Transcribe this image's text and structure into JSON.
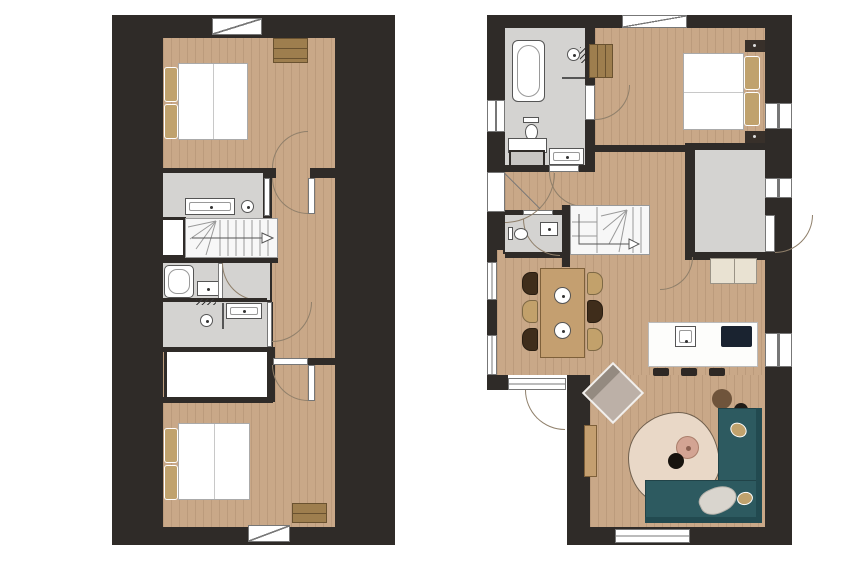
{
  "palette": {
    "page_bg": "#ffffff",
    "wall": "#2f2b28",
    "wood": "#c9a888",
    "wood_grain": "rgba(96,66,40,0.13)",
    "tile": "#d4d3d1",
    "stair": "#f7f7f7",
    "line": "#8f7f6a",
    "window_line": "#777777",
    "fixture_line": "#555555",
    "sofa": "#2d5a60",
    "sofa_dark": "#224a50",
    "rug": "#e9d8c7",
    "rug_line": "#70604e",
    "coffee": "#d3a493",
    "coffee_line": "#aa7e6b",
    "armchair": "#bcb0a7",
    "armchair_back": "#948a80",
    "pouf_brown": "#6f543b",
    "pouf_black": "#201c17",
    "chair_dark": "#3f2d1b",
    "chair_tan": "#c2a16b",
    "furn_wood": "#c49f70",
    "furn_wood_line": "#7e603a",
    "dresser": "#9e7e4e",
    "dresser_line": "#6a5230",
    "pillow": "#c0a26d",
    "cooktop": "#1a2330",
    "cabinet": "#e9e2d2",
    "sideboard": "#c8c6c3",
    "stool": "#2e2824",
    "throw": "#d9d5ce",
    "duvet_line": "#c8c8c8"
  },
  "icons": [
    "bathtub-icon",
    "shower-head-icon",
    "shower-drain-icon",
    "toilet-icon",
    "sink-icon",
    "towel-radiator-icon",
    "stairs-arrow-icon",
    "door-swing-arc",
    "window-symbol",
    "kitchen-sink-icon",
    "cooktop-icon",
    "plate-icon",
    "lamp-icon"
  ],
  "plans": [
    {
      "id": "plan-left",
      "rooms": [
        "bedroom",
        "bathroom",
        "stairs",
        "shower-room",
        "bathroom-small",
        "storage",
        "hallway",
        "bedroom"
      ]
    },
    {
      "id": "plan-right",
      "rooms": [
        "bathroom",
        "bedroom",
        "hallway",
        "wc",
        "stairs",
        "storage",
        "dining-area",
        "kitchen",
        "living-area"
      ]
    }
  ]
}
